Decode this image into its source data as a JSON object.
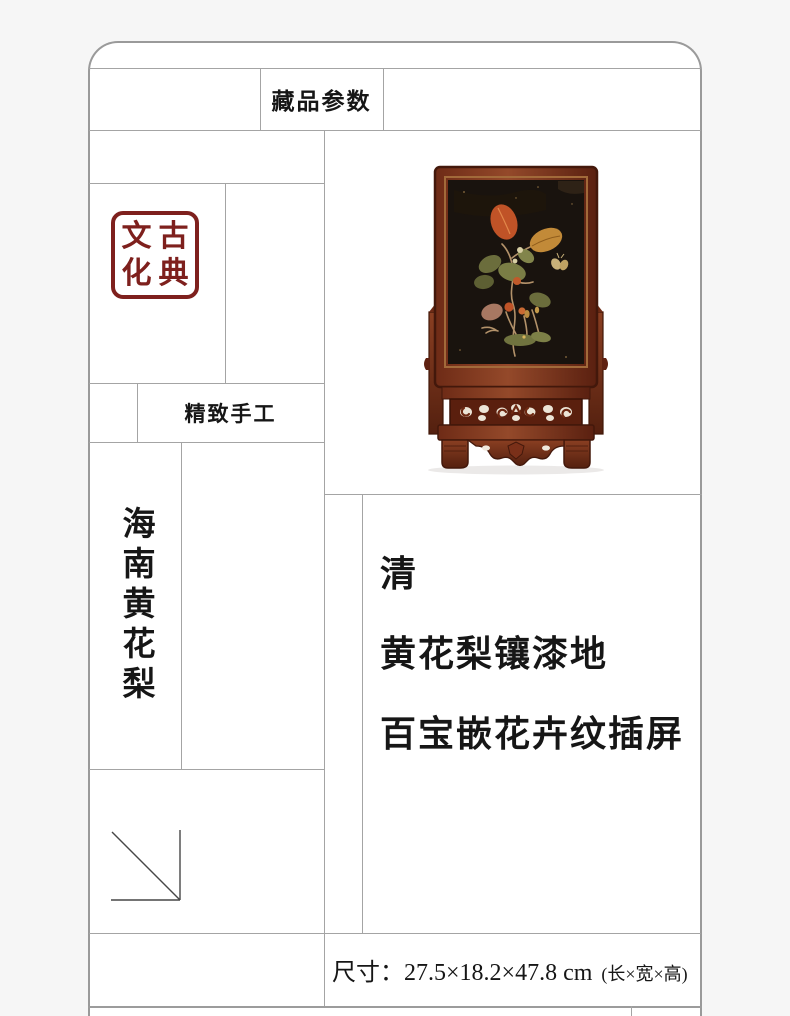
{
  "header": {
    "title": "藏品参数"
  },
  "seal": {
    "top_left": "文",
    "top_right": "古",
    "bottom_left": "化",
    "bottom_right": "典",
    "full_text": "古典文化",
    "color": "#7e201d"
  },
  "craft_label": {
    "text": "精致手工"
  },
  "material_label": {
    "text": "海南黄花梨"
  },
  "description": {
    "dynasty": "清",
    "line2": "黄花梨镶漆地",
    "line3": "百宝嵌花卉纹插屏"
  },
  "dimensions": {
    "text": "尺寸：27.5×18.2×47.8 cm",
    "note": "(长×宽×高)"
  },
  "photo_palette": {
    "wood": "#8a3f22",
    "wood_dark": "#54200f",
    "lacquer": "#19130e",
    "inlay_red": "#c05327",
    "inlay_gold": "#c28a38",
    "inlay_green": "#6b6d3c",
    "butterfly": "#c9b179"
  },
  "layout_colors": {
    "page_background": "#f6f6f6",
    "grid_line": "#a4a4a4",
    "panel_border": "#9a9a9a"
  }
}
